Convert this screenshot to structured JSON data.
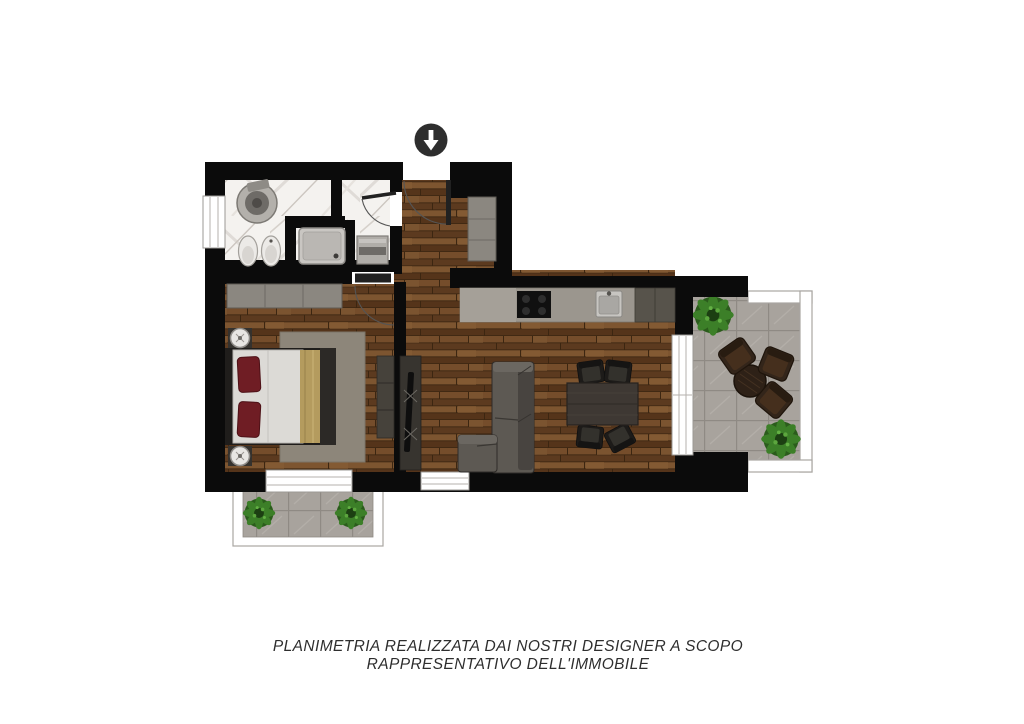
{
  "page": {
    "width": 1024,
    "height": 724,
    "background": "#ffffff"
  },
  "disclaimer": {
    "line1": "PLANIMETRIA REALIZZATA DAI NOSTRI DESIGNER A SCOPO",
    "line2": "RAPPRESENTATIVO DELL'IMMOBILE",
    "color": "#2e2e2e"
  },
  "entrance_marker": {
    "icon": "arrow-down-icon",
    "circle_color": "#2e2e2e",
    "arrow_color": "#ffffff"
  },
  "palette": {
    "wall": "#0b0b0b",
    "door_leaf": "#212121",
    "wood_floor": "#6b4627",
    "marble_floor": "#f4f2ef",
    "tile_floor": "#a8a39d",
    "railing": "#ffffff",
    "kitchen_counter": "#9b968e",
    "cabinet_gray": "#8b8780",
    "sofa_gray": "#5d5953",
    "rug": "#8d867a",
    "bed_linen": "#dcdad6",
    "pillow_red": "#6f1d24",
    "blanket_gold": "#b49b5e",
    "dining_table": "#3e3833",
    "chair_black": "#1d1b19",
    "outdoor_furniture": "#33251a",
    "plant_green": "#3c7f28"
  },
  "areas": [
    {
      "id": "bathroom",
      "floor": "marble"
    },
    {
      "id": "entry-hall",
      "floor": "wood"
    },
    {
      "id": "bedroom",
      "floor": "wood"
    },
    {
      "id": "living-room-kitchen",
      "floor": "wood"
    },
    {
      "id": "terrace",
      "floor": "tile"
    },
    {
      "id": "balcony",
      "floor": "tile"
    }
  ],
  "fixtures": [
    "entrance-arrow",
    "washbasin",
    "toilet",
    "bidet",
    "shower",
    "washing-machine",
    "entry-cabinet",
    "wardrobe",
    "double-bed",
    "nightstand",
    "bedroom-dresser",
    "tv-unit",
    "corner-sofa",
    "dining-table",
    "dining-chair",
    "kitchen-counter",
    "cooktop",
    "kitchen-sink",
    "tall-kitchen-unit",
    "outdoor-table",
    "outdoor-chair",
    "plant",
    "terrace-railing",
    "balcony-railing",
    "window",
    "door"
  ]
}
